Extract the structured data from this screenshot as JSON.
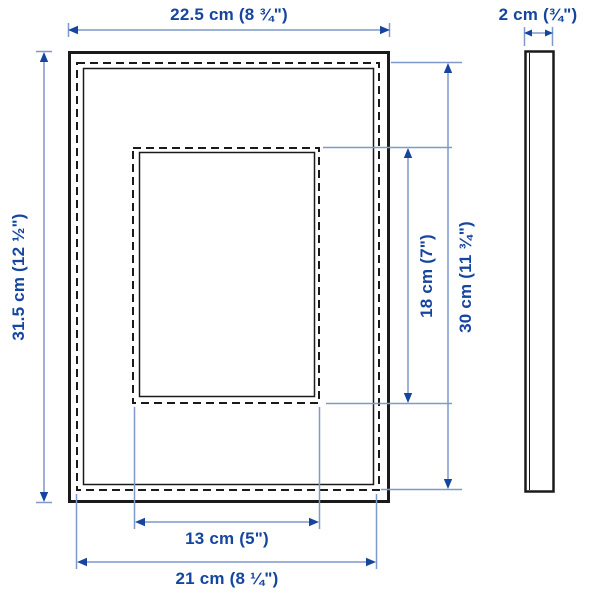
{
  "title": "Picture frame dimension diagram",
  "colors": {
    "background": "#ffffff",
    "stroke": "#1a1a1a",
    "line": "#7f99cc",
    "accent": "#15459f"
  },
  "labels": {
    "frame_width": "22.5 cm (8 ¾\")",
    "frame_depth": "2 cm (¾\")",
    "frame_height": "31.5 cm (12 ½\")",
    "opening_height": "18 cm (7\")",
    "picture_height": "30 cm (11 ¾\")",
    "opening_width": "13 cm (5\")",
    "picture_width": "21 cm (8 ¼\")"
  }
}
